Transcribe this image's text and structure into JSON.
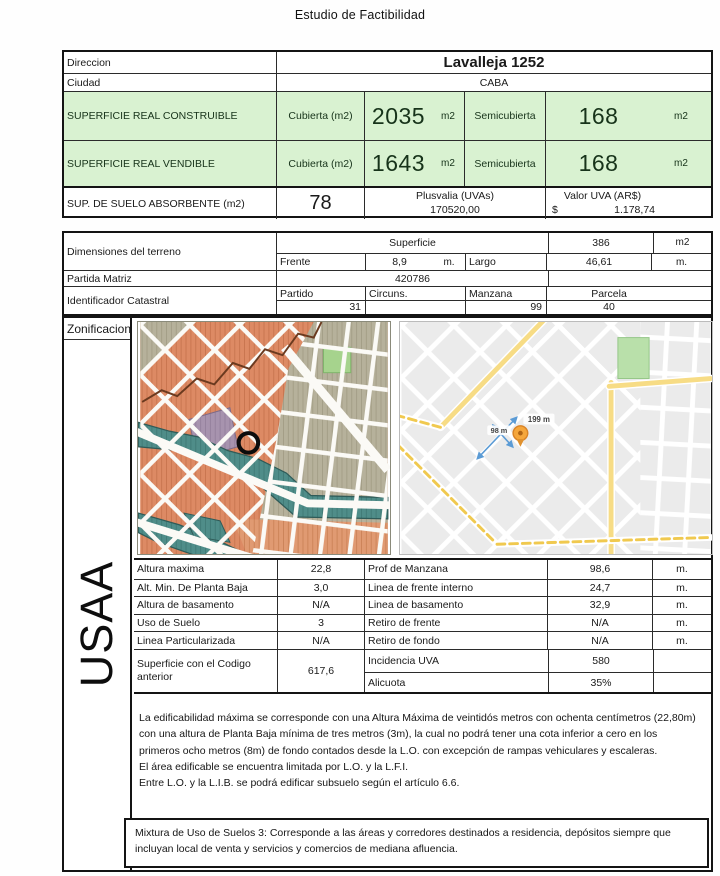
{
  "doc": {
    "title": "Estudio de Factibilidad"
  },
  "header_table": {
    "direccion_label": "Direccion",
    "direccion_value": "Lavalleja 1252",
    "ciudad_label": "Ciudad",
    "ciudad_value": "CABA",
    "rows": [
      {
        "label": "SUPERFICIE REAL CONSTRUIBLE",
        "cub_label": "Cubierta (m2)",
        "cub_value": "2035",
        "cub_unit": "m2",
        "semi_label": "Semicubierta",
        "semi_value": "168",
        "semi_unit": "m2"
      },
      {
        "label": "SUPERFICIE REAL VENDIBLE",
        "cub_label": "Cubierta (m2)",
        "cub_value": "1643",
        "cub_unit": "m2",
        "semi_label": "Semicubierta",
        "semi_value": "168",
        "semi_unit": "m2"
      }
    ],
    "absorbente": {
      "label": "SUP. DE SUELO ABSORBENTE (m2)",
      "value": "78",
      "plusvalia_label": "Plusvalia (UVAs)",
      "plusvalia_value": "170520,00",
      "uva_label": "Valor UVA (AR$)",
      "uva_symbol": "$",
      "uva_value": "1.178,74"
    }
  },
  "terrain_table": {
    "dimensiones_label": "Dimensiones del terreno",
    "superficie_label": "Superficie",
    "superficie_value": "386",
    "superficie_unit": "m2",
    "frente_label": "Frente",
    "frente_value": "8,9",
    "frente_unit": "m.",
    "largo_label": "Largo",
    "largo_value": "46,61",
    "largo_unit": "m.",
    "partida_label": "Partida Matriz",
    "partida_value": "420786",
    "catastral_label": "Identificador Catastral",
    "partido_label": "Partido",
    "partido_value": "31",
    "circuns_label": "Circuns.",
    "circuns_value": "",
    "manzana_label": "Manzana",
    "manzana_value": "99",
    "parcela_label": "Parcela",
    "parcela_value": "40"
  },
  "zoning": {
    "zonificacion_label": "Zonificacion",
    "code": "USAA",
    "map_measure_long": "199 m",
    "map_measure_short": "98 m",
    "attr_left": [
      {
        "label": "Altura maxima",
        "value": "22,8"
      },
      {
        "label": "Alt. Min. De Planta Baja",
        "value": "3,0"
      },
      {
        "label": "Altura de basamento",
        "value": "N/A"
      },
      {
        "label": "Uso de Suelo",
        "value": "3"
      },
      {
        "label": "Linea Particularizada",
        "value": "N/A"
      }
    ],
    "attr_left_big": {
      "label": "Superficie con el Codigo anterior",
      "value": "617,6"
    },
    "attr_right": [
      {
        "label": "Prof de Manzana",
        "value": "98,6",
        "unit": "m."
      },
      {
        "label": "Linea de frente interno",
        "value": "24,7",
        "unit": "m."
      },
      {
        "label": "Linea de basamento",
        "value": "32,9",
        "unit": "m."
      },
      {
        "label": "Retiro de frente",
        "value": "N/A",
        "unit": "m."
      },
      {
        "label": "Retiro de fondo",
        "value": "N/A",
        "unit": "m."
      }
    ],
    "attr_right_big": [
      {
        "label": "Incidencia UVA",
        "value": "580",
        "unit": ""
      },
      {
        "label": "Alicuota",
        "value": "35%",
        "unit": ""
      }
    ],
    "notes": [
      "La edificabilidad máxima se corresponde con una Altura Máxima de veintidós metros con ochenta centímetros (22,80m) con una altura de Planta Baja mínima de tres metros (3m), la cual no podrá tener una cota inferior a cero en los primeros ocho metros (8m) de fondo contados desde la L.O. con excepción de rampas vehiculares y escaleras.",
      "El área edificable se encuentra limitada por L.O. y la L.F.I.",
      "Entre L.O. y la L.I.B. se podrá edificar subsuelo según el artículo 6.6."
    ],
    "mixtura_note": "Mixtura de Uso de Suelos 3: Corresponde a las áreas y corredores destinados a residencia, depósitos siempre que incluyan local de venta y servicios y comercios de mediana afluencia."
  },
  "colors": {
    "highlight_green_fill": "#d9f2d1",
    "zoning_orange": "#dd8a64",
    "zoning_teal": "#4f8d89",
    "zoning_khaki": "#b6b19b",
    "zoning_purple": "#a793ae",
    "map_road_yellow": "#f7dc85",
    "map_park_green": "#b9e0aa",
    "pin_orange": "#f5a63b",
    "measure_blue": "#5b9bd5"
  }
}
